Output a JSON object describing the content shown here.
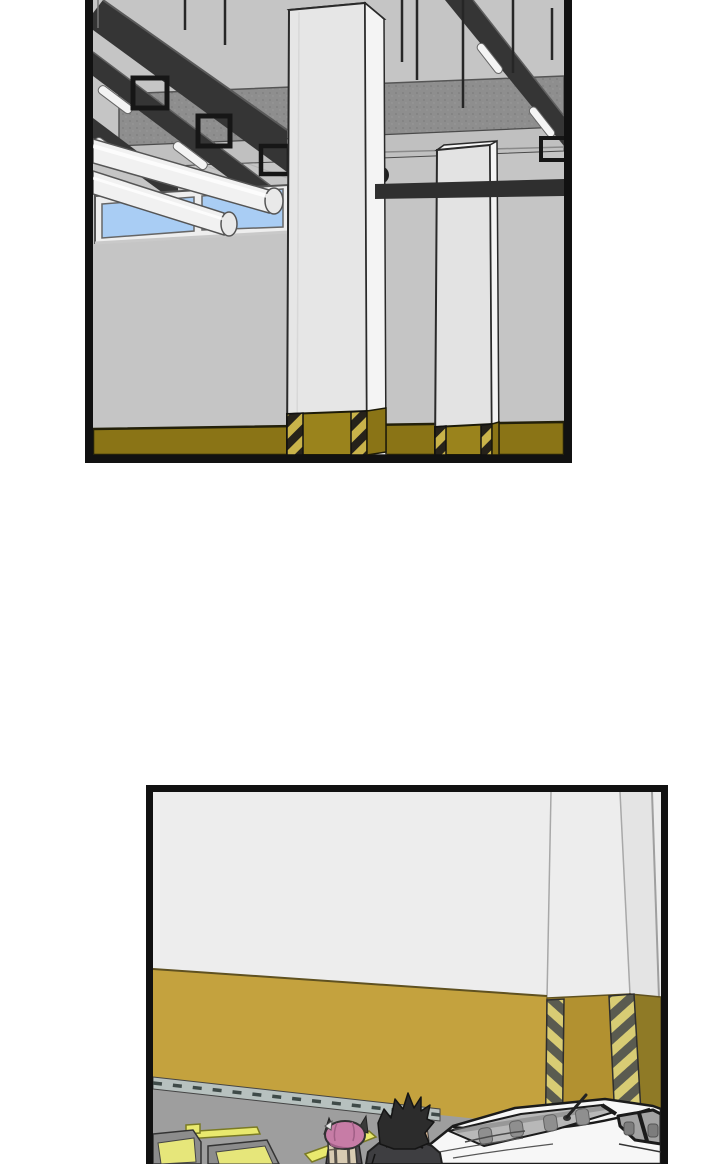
{
  "page": {
    "width": 728,
    "height": 1164,
    "background": "#ffffff",
    "description": "Webtoon comic page, two black-bordered panels, parking-garage interior, no visible text"
  },
  "colors": {
    "panelBorder": "#111111",
    "wallGray": "#c5c5c5",
    "concrete": "#8e8e8e",
    "concreteLight": "#c0c0c0",
    "beamDark": "#353535",
    "beamDarker": "#2f2f2f",
    "lampWhite": "#f4f4f4",
    "pipeWhite": "#f1f1f1",
    "pipeCap": "#e9e9e9",
    "windowBlue": "#a9cdf4",
    "frameWhite": "#eeeeee",
    "pillarFront": "#e6e6e6",
    "pillarFront2": "#e3e3e3",
    "pillarSide": "#f4f4f4",
    "pillarTop": "#f7f7f7",
    "oliveDark": "#8a7416",
    "oliveBase": "#9a831c",
    "hazardYellow": "#c9b34a",
    "hazardDark": "#26221a",
    "wallWhite2": "#ededed",
    "sideShade": "#e4e4e4",
    "goldBand": "#c4a23e",
    "goldPillar": "#b29130",
    "goldSide": "#8f7a26",
    "chevronYellow": "#d8cc74",
    "chevronGray": "#5a5b50",
    "floorGray": "#9e9e9e",
    "curb": "#b7c1bf",
    "markYellow": "#e9e96e",
    "stopGray": "#8c8c8c",
    "stopYellow": "#e6e67a",
    "carWhite": "#f7f7f7",
    "glassGray": "#b8b8b8",
    "sideGlass": "#a3a3a3",
    "seatGray": "#8f8f8f",
    "seatDark": "#7d7d7d",
    "hairPink": "#c77ca6",
    "hairPinkShade": "#a05f86",
    "hairDark": "#2c2c2c",
    "hornDark": "#3a3a3a",
    "jacketDark": "#3e3e41",
    "bodyDark": "#4e4a50",
    "skin": "#e3bf9a",
    "backpackTan": "#d8cbb2",
    "fixtureDark": "#1f1f1f",
    "outline": "#1b1b1b"
  },
  "panels": {
    "top": {
      "name": "garage-ceiling-panel",
      "scene": "Parking garage ceiling: diagonal steel rails with fluorescent lamps, hanger rods and brackets, speckled concrete beam, two white pipes, blue clerestory window, tall concrete pillar and second pillar, olive wainscot with black-yellow hazard stripes at pillar bases"
    },
    "bottom": {
      "name": "garage-wall-panel",
      "scene": "Parking garage wall: white upper wall, gold lower band, corner pillar with chevron hazard strips, gray floor with yellow lane markings, two wheel stops, pink-haired horned character with tan backpack, black-spiky-haired character in dark jacket, white sedan with antenna"
    }
  }
}
